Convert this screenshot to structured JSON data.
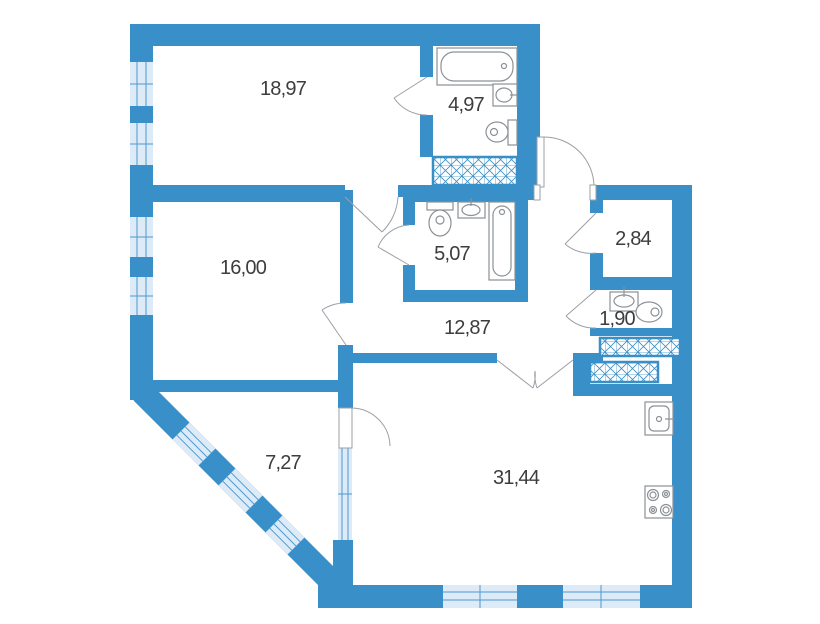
{
  "plan": {
    "type": "apartment-floor-plan",
    "area_unit": "m2",
    "decimal_separator": ",",
    "rooms": [
      {
        "id": "room-18-97",
        "area_label": "18,97",
        "fixtures": []
      },
      {
        "id": "bathroom-4-97",
        "area_label": "4,97",
        "fixtures": [
          "bathtub",
          "wash-basin",
          "toilet",
          "ventilation-shaft"
        ]
      },
      {
        "id": "room-16-00",
        "area_label": "16,00",
        "fixtures": []
      },
      {
        "id": "bathroom-5-07",
        "area_label": "5,07",
        "fixtures": [
          "toilet",
          "wash-basin",
          "bathtub"
        ]
      },
      {
        "id": "storage-2-84",
        "area_label": "2,84",
        "fixtures": []
      },
      {
        "id": "wc-1-90",
        "area_label": "1,90",
        "fixtures": [
          "wash-basin",
          "toilet",
          "ventilation-shaft"
        ]
      },
      {
        "id": "hallway-12-87",
        "area_label": "12,87",
        "fixtures": []
      },
      {
        "id": "loggia-7-27",
        "area_label": "7,27",
        "fixtures": []
      },
      {
        "id": "living-kitchen-31-44",
        "area_label": "31,44",
        "fixtures": [
          "kitchen-sink",
          "stove"
        ]
      }
    ],
    "colors": {
      "wall": "#3990C9",
      "window_fill": "#DCEBF7",
      "window_frame": "#4E9ACF",
      "fixture_stroke": "#8C9196",
      "door_arc": "#9AA0A6",
      "label_text": "#3D3D3D",
      "background": "#FFFFFF"
    }
  }
}
